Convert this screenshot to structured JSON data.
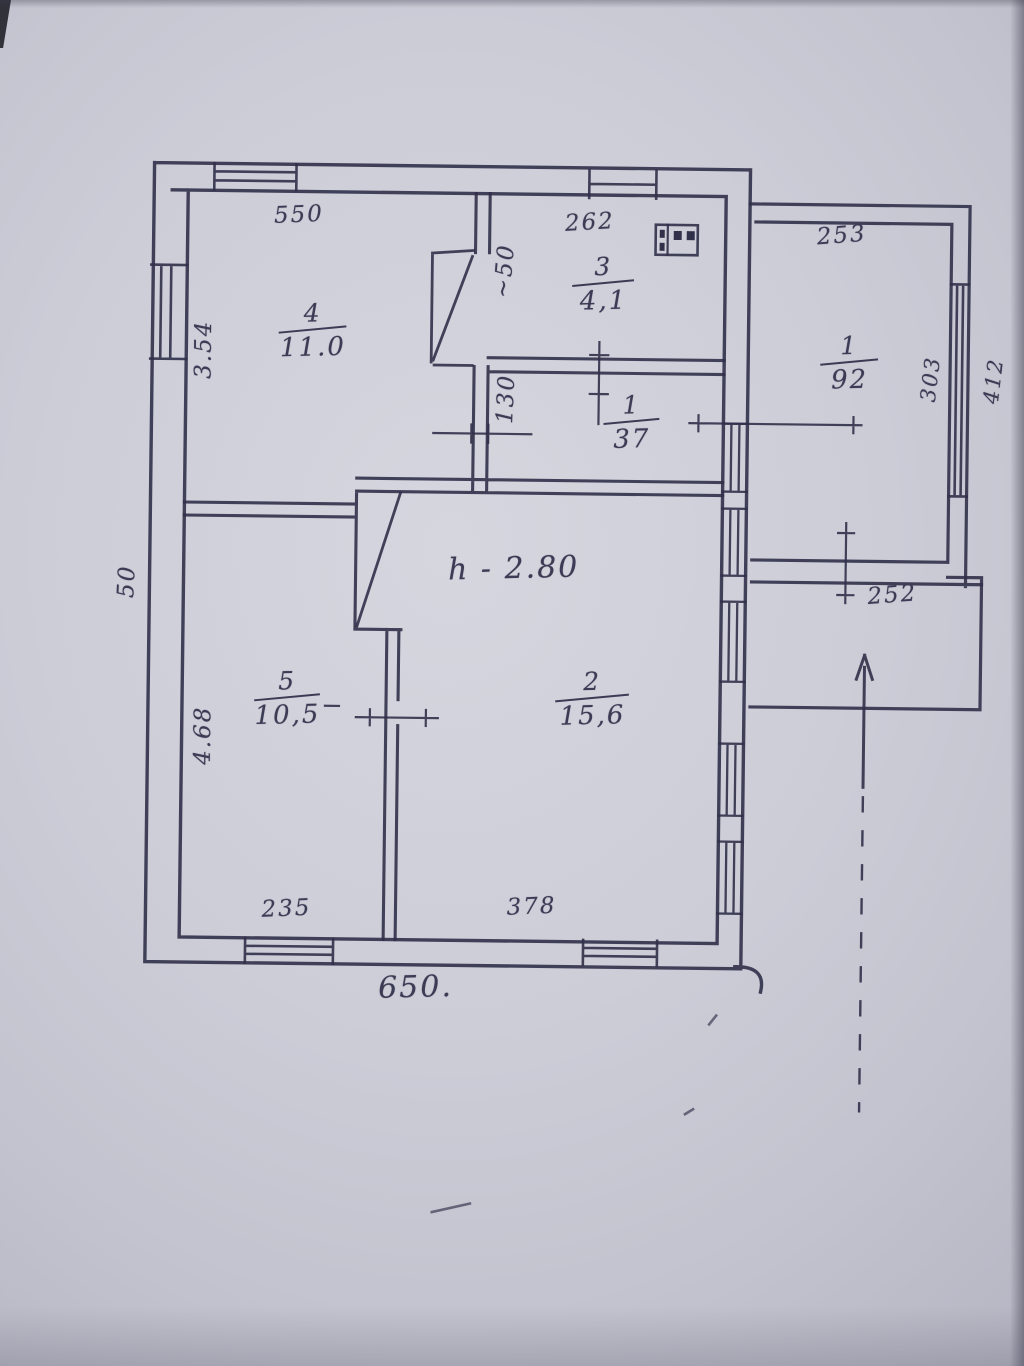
{
  "plan": {
    "height_note": "h - 2.80",
    "rooms": {
      "room4": {
        "number": "4",
        "area": "11.0"
      },
      "room3": {
        "number": "3",
        "area": "4,1"
      },
      "annex": {
        "number": "1",
        "area": "92"
      },
      "hall": {
        "number": "1",
        "area": "37"
      },
      "room5": {
        "number": "5",
        "area": "10,5"
      },
      "room2": {
        "number": "2",
        "area": "15,6"
      }
    },
    "dimensions": {
      "room4_width_top": "550",
      "room3_width_top": "262",
      "annex_width_top": "253",
      "room4_height_left": "3.54",
      "room5_height_left": "4.68",
      "left_wall_note": "50",
      "closet_width": "~50",
      "hall_width": "130",
      "annex_height_inner": "303",
      "annex_height_outer": "412",
      "porch_width": "252",
      "room5_width_bottom": "235",
      "room2_width_bottom": "378",
      "house_width_total": "650."
    }
  }
}
